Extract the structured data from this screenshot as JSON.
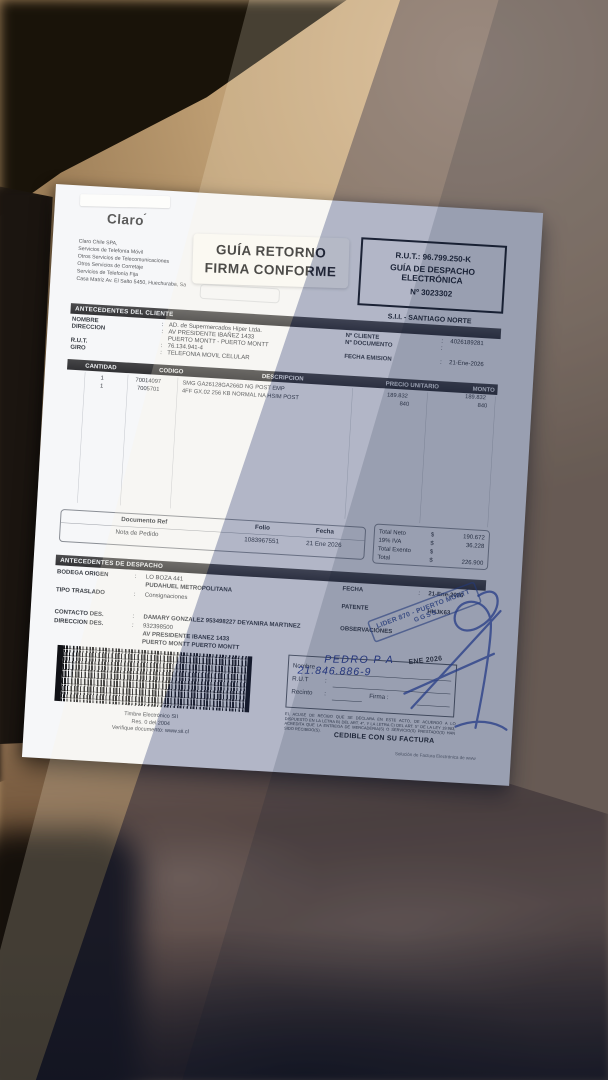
{
  "sep": ":",
  "document": {
    "supplier": {
      "logo_text": "Claro",
      "logo_accent": "´",
      "info_lines": [
        "Claro Chile SPA,",
        "Servicios de Telefonía Móvil",
        "Otros Servicios de Telecomunicaciones",
        "Otros Servicios de Corretaje",
        "Servicios de Telefonía Fija",
        "Casa Matriz Av. El Salto 5450, Huechuraba, Sa"
      ]
    },
    "return_stamp": {
      "line1": "GUÍA RETORNO",
      "line2": "FIRMA CONFORME"
    },
    "header_box": {
      "rut": "R.U.T.: 96.799.250-K",
      "doc_type_line1": "GUÍA DE DESPACHO",
      "doc_type_line2": "ELECTRÓNICA",
      "number": "Nº 3023302",
      "sii_office": "S.I.I. - SANTIAGO NORTE"
    },
    "client_section": {
      "title": "ANTECEDENTES DEL CLIENTE",
      "nombre_label": "NOMBRE",
      "nombre_value": "AD. de Supermercados Hiper Ltda.",
      "direccion_label": "DIRECCION",
      "direccion_value": "AV PRESIDENTE IBAÑEZ 1433",
      "direccion_value2": "PUERTO MONTT -  PUERTO MONTT",
      "rut_label": "R.U.T.",
      "rut_value": "76.134.941-4",
      "giro_label": "GIRO",
      "giro_value": "TELEFONIA MOVIL CELULAR",
      "ncliente_label": "Nº CLIENTE",
      "ncliente_value": "4026189281",
      "ndocumento_label": "Nº DOCUMENTO",
      "ndocumento_value": "",
      "fecha_label": "FECHA EMISION",
      "fecha_value": "21-Ene-2026"
    },
    "items_table": {
      "headers": [
        "CANTIDAD",
        "CODIGO",
        "DESCRIPCION",
        "PRECIO UNITARIO",
        "MONTO"
      ],
      "rows": [
        {
          "cantidad": "1",
          "codigo": "70014097",
          "descripcion": "SMG GA26128GA266D NG POST EMP",
          "precio": "189.832",
          "monto": "189.832"
        },
        {
          "cantidad": "1",
          "codigo": "7005701",
          "descripcion": "4FF GX.02 256 KB NORMAL NA HSIM POST",
          "precio": "840",
          "monto": "840"
        }
      ]
    },
    "ref_table": {
      "headers": [
        "Documento Ref",
        "Folio",
        "Fecha"
      ],
      "row": [
        "Nota de Pedido",
        "1083967551",
        "21 Ene 2026"
      ]
    },
    "totals": {
      "rows": [
        {
          "label": "Total Neto",
          "currency": "$",
          "value": "190.672"
        },
        {
          "label": "19% IVA",
          "currency": "$",
          "value": "36.228"
        },
        {
          "label": "Total Exento",
          "currency": "$",
          "value": ""
        },
        {
          "label": "Total",
          "currency": "$",
          "value": "226.900"
        }
      ]
    },
    "dispatch_section": {
      "title": "ANTECEDENTES DE DESPACHO",
      "bodega_label": "BODEGA ORIGEN",
      "bodega_value": "LO BOZA 441",
      "bodega_value2": "PUDAHUEL  METROPOLITANA",
      "tipo_label": "TIPO TRASLADO",
      "tipo_value": "Consignaciones",
      "fecha_label": "FECHA",
      "fecha_value": "21-Ene-2026",
      "patente_label": "PATENTE",
      "patente_value": "HHJK63",
      "contacto_label": "CONTACTO DES.",
      "contacto_value": "DAMARY GONZALEZ 953498227 DEYANIRA MARTINEZ",
      "observaciones_label": "OBSERVACIONES",
      "direccion_label": "DIRECCION DES.",
      "direccion_value": "932398500",
      "direccion_value2": "AV PRESIDENTE IBANEZ 1433",
      "direccion_value3": "PUERTO MONTT  PUERTO MONTT"
    },
    "lider_stamp": {
      "line1": "LIDER 870 - PUERTO MONTT",
      "line2": "GGSS"
    },
    "receipt_box": {
      "nombre_label": "Nombre",
      "rut_label": "R.U.T",
      "recinto_label": "Recinto",
      "firma_label": "Firma :",
      "handwritten_name": "PEDRO P A",
      "handwritten_rut": "21.846.886-9",
      "date_stamp": "ENE 2026"
    },
    "timbre": {
      "line1": "Timbre Electrónico SII",
      "line2": "Res. 0 del 2004",
      "line3": "Verifique documento: www.sii.cl"
    },
    "legal_text": "EL ACUSE DE RECIBO QUE SE DECLARA EN ESTE ACTO, DE ACUERDO A LO DISPUESTO EN LA LETRA B) DEL ART. 4°, Y LA LETRA C) DEL ART. 5° DE LA LEY 19.983, ACREDITA QUE LA ENTREGA DE MERCADERIA(S) O SERVICIO(S) PRESTADO(S) HAN SIDO RECIBIDO(S).",
    "cedible": "CEDIBLE CON SU FACTURA",
    "footer_note": "Solución de Factura Electrónica de www"
  }
}
